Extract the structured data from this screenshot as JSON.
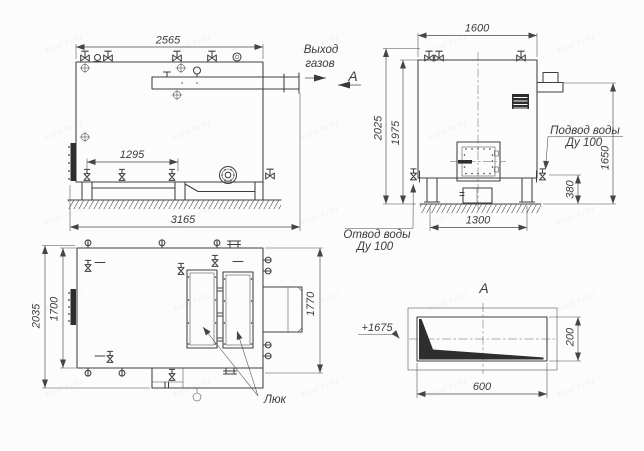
{
  "watermark": {
    "text": "kotel-kv.kz"
  },
  "side_view": {
    "dim_top_width": "2565",
    "dim_valve_span": "1295",
    "dim_overall_length": "3165",
    "label_gas_outlet_1": "Выход",
    "label_gas_outlet_2": "газов",
    "section_arrow_label": "А"
  },
  "front_view": {
    "dim_top_width": "1600",
    "dim_overall_height": "2025",
    "dim_body_height": "1975",
    "dim_inlet_height": "1650",
    "dim_drain_height": "380",
    "dim_base_width": "1300",
    "label_water_inlet_1": "Подвод воды",
    "label_water_inlet_2": "Ду 100",
    "label_water_drain_1": "Отвод воды",
    "label_water_drain_2": "Ду 100"
  },
  "plan_view": {
    "dim_overall_width": "2035",
    "dim_body_width": "1700",
    "dim_right_height": "1770",
    "label_hatch": "Люк"
  },
  "section_view": {
    "title": "А",
    "dim_width": "600",
    "dim_height": "200",
    "level_mark": "+1675"
  }
}
